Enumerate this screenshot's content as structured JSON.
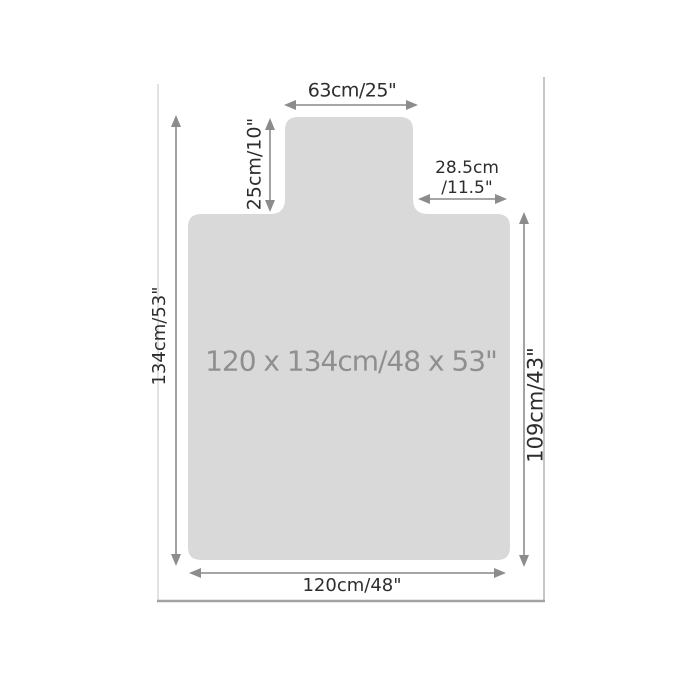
{
  "figure": {
    "center_label": "120 x 134cm/48 x 53\"",
    "dimensions": {
      "lip_width": "63cm/25\"",
      "lip_depth": "25cm/10\"",
      "right_notch_line1": "28.5cm",
      "right_notch_line2": "/11.5\"",
      "overall_height": "134cm/53\"",
      "body_height": "109cm/43\"",
      "overall_width": "120cm/48\""
    },
    "colors": {
      "mat_fill": "#d9d9d9",
      "arrow_line": "#999999",
      "arrow_head": "#8c8c8c",
      "dimension_text": "#2d2d2d",
      "center_text": "#8f8f8f",
      "frame_side_line": "#c6c6c6",
      "frame_bottom_line": "#a3a3a3"
    }
  }
}
